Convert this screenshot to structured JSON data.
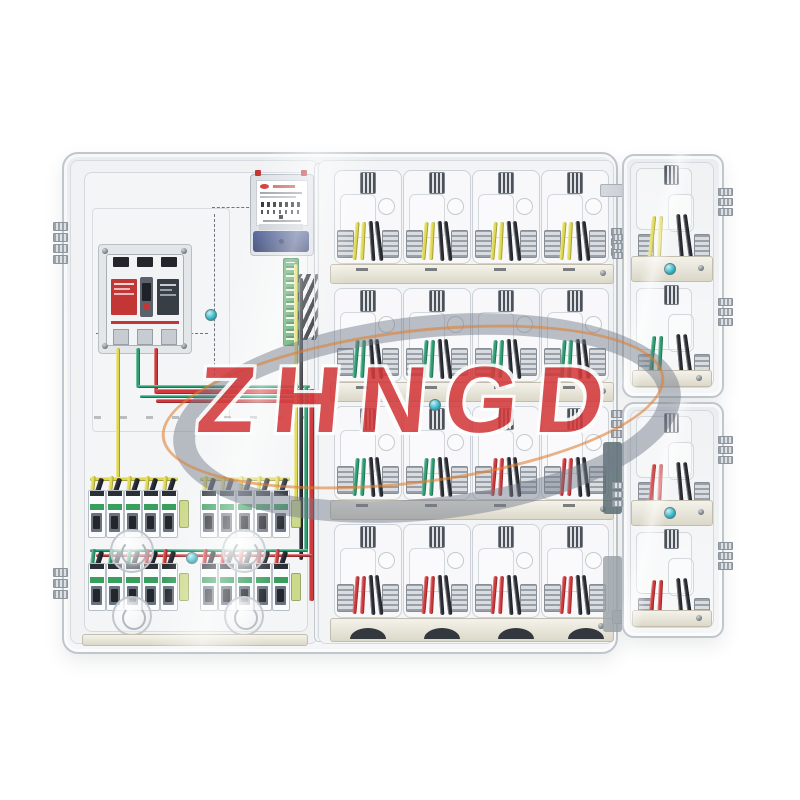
{
  "photo": {
    "description": "Transparent multi-position electricity meter distribution box set with wired circuit breakers",
    "watermark_brand": "ZHNGD"
  },
  "colors": {
    "yellow": "#e0d94f",
    "green": "#2f9e72",
    "red": "#cf3a3c",
    "black": "#2b2f35",
    "navy_meter_cover": "#3d4e86",
    "teal_screw": "#2fb3c4",
    "rail_beige": "#e9e6d9",
    "pcb_green": "#3c9a4e",
    "breaker_red_label": "#c23636",
    "swoosh_gray": "#7d8694",
    "arc_orange": "#dd8136",
    "brand_red": "#d43a3c"
  },
  "main_box": {
    "right_panel": {
      "positions_per_row": 4,
      "rows": [
        {
          "name": "row-1",
          "cell_wire_colors": [
            "yellow",
            "yellow",
            "yellow",
            "yellow"
          ]
        },
        {
          "name": "row-2",
          "cell_wire_colors": [
            "green",
            "green",
            "green",
            "green"
          ]
        },
        {
          "name": "row-3",
          "cell_wire_colors": [
            "green",
            "green",
            "red",
            "red"
          ]
        },
        {
          "name": "row-4",
          "cell_wire_colors": [
            "red",
            "red",
            "red",
            "red"
          ]
        }
      ]
    },
    "left_panel": {
      "mcb_rows": [
        {
          "name": "row-A",
          "feeder_colors": [
            "yellow"
          ],
          "groups": [
            {
              "unit_wire_colors": [
                "yellow",
                "yellow",
                "yellow",
                "yellow",
                "yellow"
              ]
            },
            {
              "unit_wire_colors": [
                "yellow",
                "yellow",
                "yellow",
                "yellow",
                "yellow"
              ]
            }
          ]
        },
        {
          "name": "row-B",
          "feeder_colors": [
            "green",
            "red"
          ],
          "groups": [
            {
              "unit_wire_colors": [
                "green",
                "green",
                "green",
                "red",
                "red"
              ]
            },
            {
              "unit_wire_colors": [
                "red",
                "red",
                "red",
                "red",
                "red"
              ]
            }
          ]
        }
      ]
    }
  },
  "side_boxes": {
    "top": {
      "cell_wire_colors": [
        "yellow",
        "green"
      ]
    },
    "bottom": {
      "cell_wire_colors": [
        "red",
        "red"
      ]
    }
  }
}
